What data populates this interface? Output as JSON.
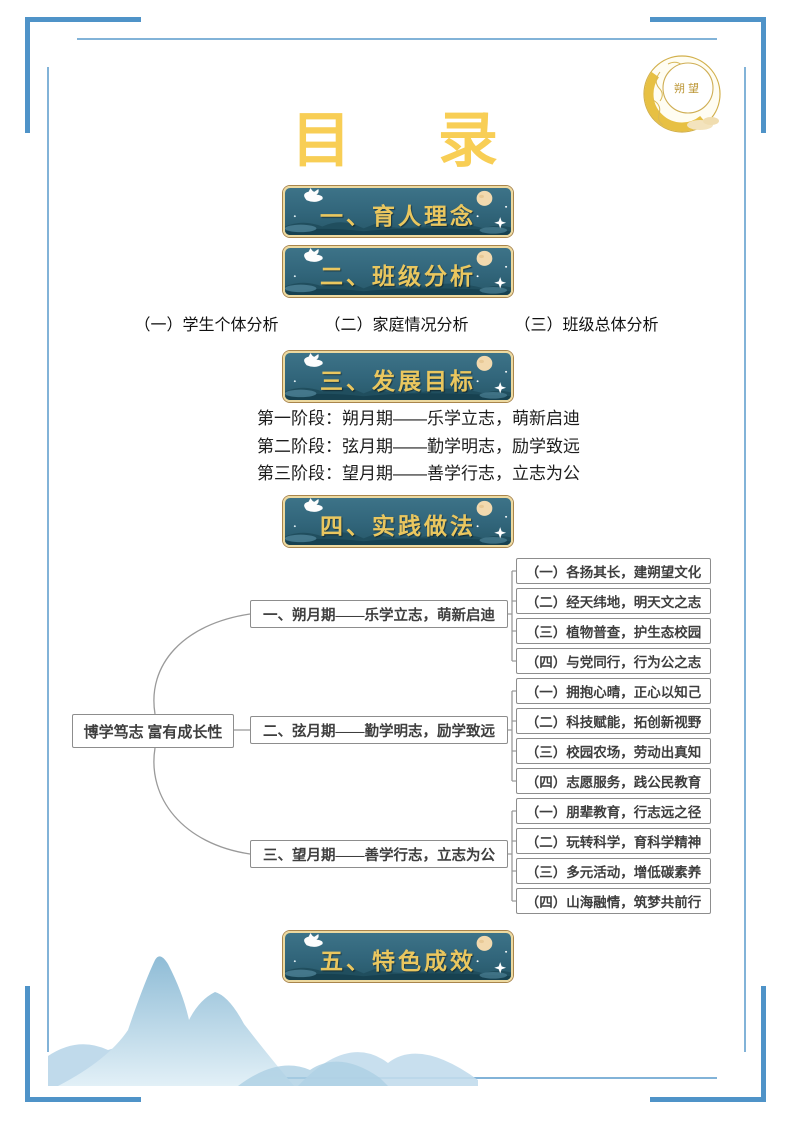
{
  "title": "目 录",
  "logo": {
    "text": "朔望"
  },
  "banners": [
    "一、育人理念",
    "二、班级分析",
    "三、发展目标",
    "四、实践做法",
    "五、特色成效"
  ],
  "class_analysis_items": [
    "（一）学生个体分析",
    "（二）家庭情况分析",
    "（三）班级总体分析"
  ],
  "development_stages": [
    "第一阶段：朔月期——乐学立志，萌新启迪",
    "第二阶段：弦月期——勤学明志，励学致远",
    "第三阶段：望月期——善学行志，立志为公"
  ],
  "mindmap": {
    "root": "博学笃志 富有成长性",
    "branches": [
      {
        "label": "一、朔月期——乐学立志，萌新启迪",
        "children": [
          "（一）各扬其长，建朔望文化",
          "（二）经天纬地，明天文之志",
          "（三）植物普查，护生态校园",
          "（四）与党同行，行为公之志"
        ]
      },
      {
        "label": "二、弦月期——勤学明志，励学致远",
        "children": [
          "（一）拥抱心晴，正心以知己",
          "（二）科技赋能，拓创新视野",
          "（三）校园农场，劳动出真知",
          "（四）志愿服务，践公民教育"
        ]
      },
      {
        "label": "三、望月期——善学行志，立志为公",
        "children": [
          "（一）朋辈教育，行志远之径",
          "（二）玩转科学，育科学精神",
          "（三）多元活动，增低碳素养",
          "（四）山海融情，筑梦共前行"
        ]
      }
    ]
  },
  "colors": {
    "title_gold": "#f8ce55",
    "banner_bg": "#31657a",
    "banner_text": "#eac75f",
    "banner_border": "#ecd9a0",
    "frame_blue": "#4f93c8",
    "mountain_blue": "#a9cde2"
  }
}
